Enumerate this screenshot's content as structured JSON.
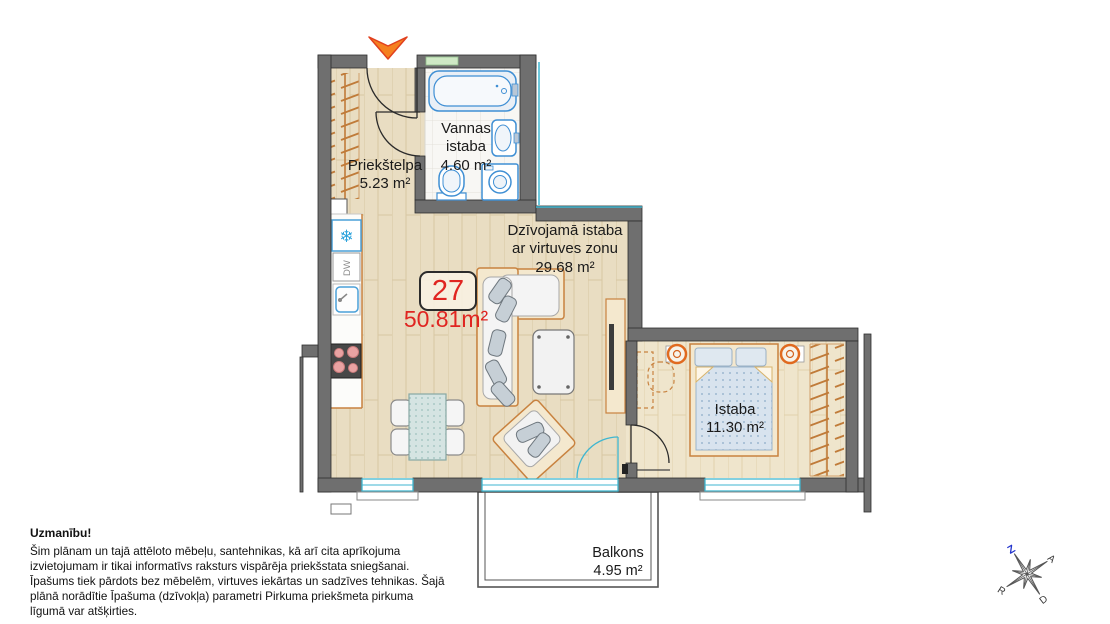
{
  "plan": {
    "apartment_number": "27",
    "total_area": "50.81m²",
    "rooms": {
      "hallway": {
        "name": "Priekštelpa",
        "area": "5.23 m²"
      },
      "bathroom": {
        "name": "Vannas istaba",
        "area": "4.60 m²"
      },
      "living": {
        "name_line1": "Dzīvojamā istaba",
        "name_line2": "ar virtuves zonu",
        "area": "29.68 m²"
      },
      "bedroom": {
        "name": "Istaba",
        "area": "11.30 m²"
      },
      "balcony": {
        "name": "Balkons",
        "area": "4.95 m²"
      }
    },
    "appliances": {
      "dishwasher": "DW"
    },
    "icons": {
      "snowflake": "❄"
    },
    "compass": {
      "north": "Z",
      "east": "A",
      "south": "D",
      "west": "R"
    }
  },
  "disclaimer": {
    "title": "Uzmanību!",
    "body": "Šim plānam un tajā attēloto mēbeļu, santehnikas, kā arī cita aprīkojuma izvietojumam ir tikai informatīvs raksturs vispārēja priekšstata sniegšanai. Īpašums tiek pārdots bez mēbelēm, virtuves iekārtas un sadzīves tehnikas. Šajā plānā norādītie Īpašuma (dzīvokļa) parametri Pirkuma priekšmeta pirkuma līgumā var atšķirties."
  },
  "colors": {
    "accent_red": "#e02521",
    "wall_gray": "#6f6f6f",
    "window_cyan": "#3fb6d0",
    "fixture_blue": "#3f8fd4",
    "furniture_orange": "#c8823f",
    "wood_floor": "#e9ddc2",
    "north_blue": "#2233cc"
  }
}
